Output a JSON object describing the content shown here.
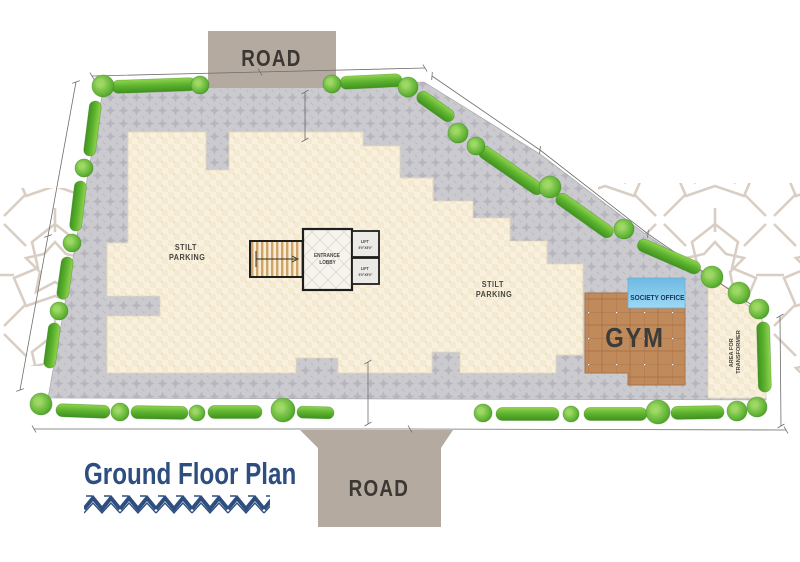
{
  "title": {
    "text": "Ground Floor Plan"
  },
  "roads": {
    "top": "ROAD",
    "bottom": "ROAD"
  },
  "areas": {
    "stilt_left": {
      "line1": "STILT",
      "line2": "PARKING"
    },
    "stilt_right": {
      "line1": "STILT",
      "line2": "PARKING"
    },
    "entrance_lobby": {
      "line1": "ENTRANCE",
      "line2": "LOBBY"
    },
    "lift_upper": {
      "name": "LIFT",
      "size": "5'0\"X5'0\""
    },
    "lift_lower": {
      "name": "LIFT",
      "size": "5'0\"X5'0\""
    },
    "society_office": "SOCIETY OFFICE",
    "gym": "GYM",
    "transformer": {
      "line1": "AREA FOR",
      "line2": "TRANSFORMER"
    }
  },
  "colors": {
    "title_navy": "#2d4e7f",
    "road_fill": "#b4aaa0",
    "road_text": "#3c3732",
    "paving_gray": "#cbcacf",
    "paving_motif": "#b7b6bf",
    "building_cream": "#f9f1de",
    "gym_brown": "#c18a5b",
    "office_blue": "#85cbee",
    "hedge_green": "#5cb22e",
    "tree_green": "#62b636",
    "ornament_taupe": "#d9cec4",
    "label_dark": "#474540"
  }
}
